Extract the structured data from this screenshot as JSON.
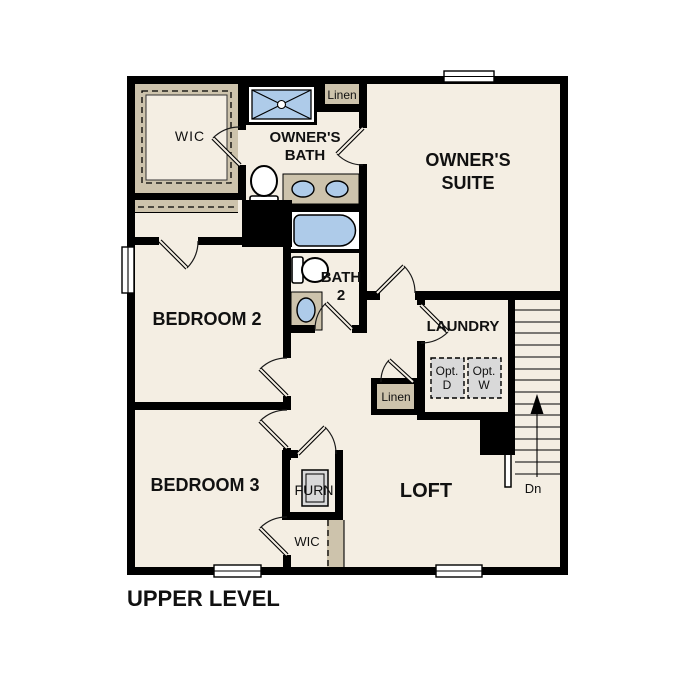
{
  "plan_title": "UPPER LEVEL",
  "colors": {
    "floor": "#f4eee3",
    "closet_tan": "#cdc3ac",
    "fixture_blue": "#aecbe9",
    "appliance_gray": "#d9d9d9",
    "wall": "#000000",
    "background": "#ffffff"
  },
  "labels": {
    "wic_upper": "WIC",
    "owners_bath_1": "OWNER'S",
    "owners_bath_2": "BATH",
    "linen_upper": "Linen",
    "owners_suite_1": "OWNER'S",
    "owners_suite_2": "SUITE",
    "bedroom2": "BEDROOM 2",
    "bath2_1": "BATH",
    "bath2_2": "2",
    "laundry": "LAUNDRY",
    "opt_dryer_1": "Opt.",
    "opt_dryer_2": "D",
    "opt_washer_1": "Opt.",
    "opt_washer_2": "W",
    "linen_mid": "Linen",
    "bedroom3": "BEDROOM 3",
    "furnace": "FURN",
    "wic_lower": "WIC",
    "loft": "LOFT",
    "stairs_down": "Dn"
  }
}
